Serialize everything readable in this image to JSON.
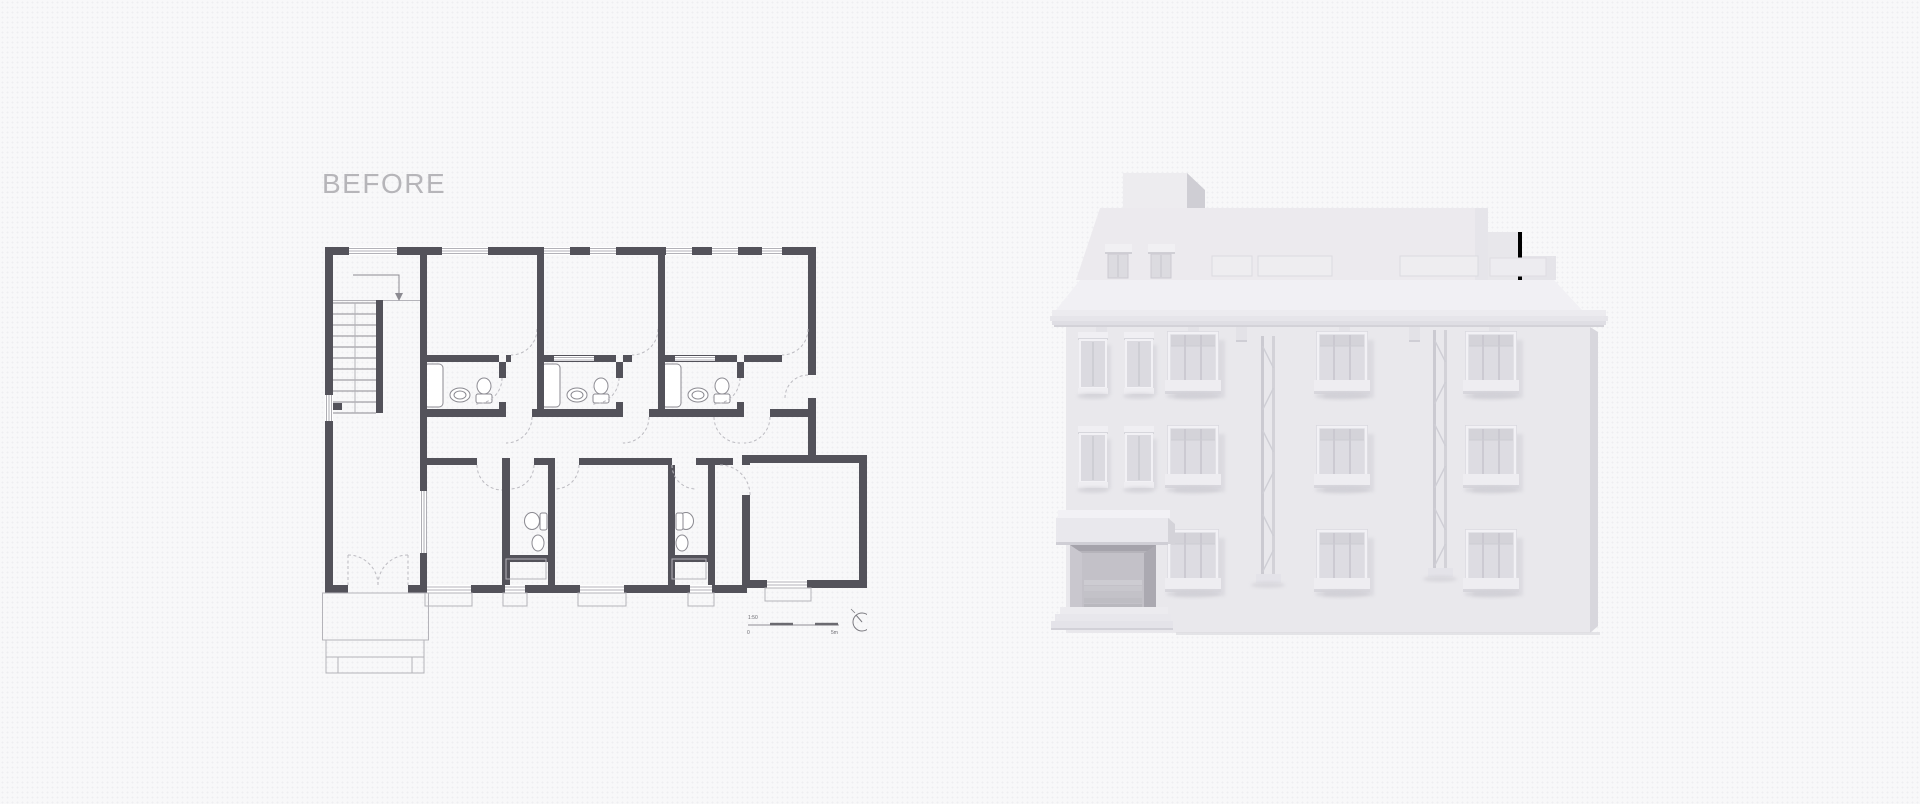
{
  "page": {
    "before_label": "BEFORE",
    "background_color": "#f8f8f9",
    "label_color": "#b6b5b9"
  },
  "floor_plan": {
    "wall_color": "#53525a",
    "fixture_line_color": "#8b8a91",
    "door_arc_color": "#bcbbc1",
    "scale_bar": {
      "ratio": "1:50",
      "zero": "0",
      "end": "5m"
    }
  },
  "building_render": {
    "facade_color": "#e9e8ec",
    "side_shade_color": "#d8d7dd",
    "entrance_recess_color": "#b5b3ba",
    "shadow_color": "#c9c8cf"
  }
}
